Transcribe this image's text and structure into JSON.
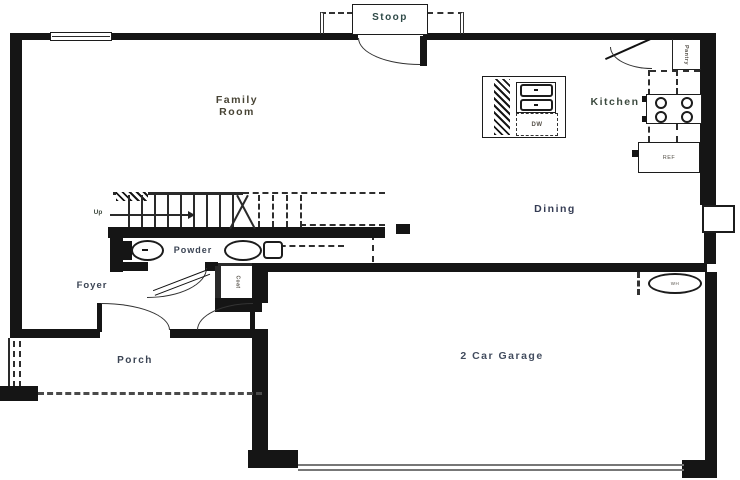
{
  "colors": {
    "wall": "#151515",
    "label": "#3b4454",
    "fixture_label": "#555048"
  },
  "labels": {
    "stoop": "Stoop",
    "family_room": "Family Room",
    "kitchen": "Kitchen",
    "pantry": "Pantry",
    "dining": "Dining",
    "powder": "Powder",
    "foyer": "Foyer",
    "porch": "Porch",
    "garage": "2 Car Garage",
    "closet": "Coat",
    "stairs": "Up",
    "dishwasher": "DW",
    "refrigerator": "REF",
    "water_heater": "WH"
  }
}
